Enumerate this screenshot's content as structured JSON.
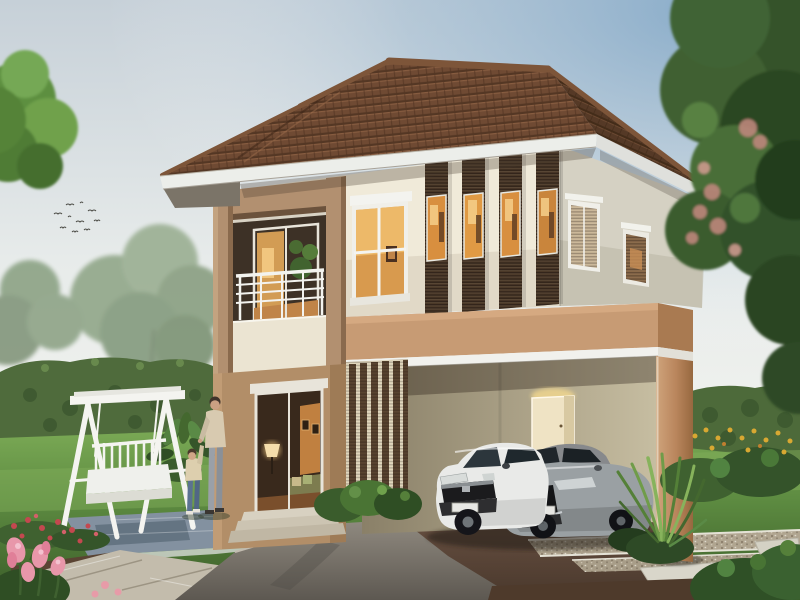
{
  "scene": {
    "type": "architectural-rendering-photo",
    "objects": [
      "two-story house with hipped tile roof",
      "balcony with white railing",
      "vertical louver window screens",
      "carport with two cars",
      "white hatchback car",
      "gray sedan car",
      "white garden swing bench",
      "adult and child walking",
      "hedges and trees",
      "lawn with stone walkway and gravel strips",
      "flower beds"
    ]
  },
  "colors": {
    "roof": "#6f4a33",
    "roof_dark": "#553926",
    "roof_ridge": "#7d5539",
    "fascia": "#eceeea",
    "wall_cream": "#f0ead9",
    "wall_side": "#d5d1c3",
    "frame_tan": "#b29070",
    "parapet": "#ebe4d2",
    "interior_dark": "#3d3126",
    "louver": "#4a3828",
    "louver_gap": "#e0d6bd",
    "carport": "#c79b74",
    "carport_side": "#a97a51",
    "trim_white": "#f1f1ed",
    "carport_wall": "#b5ab8f",
    "wall_tan": "#b28e68",
    "railing": "#f3f3ef",
    "swing": "#f4f4f0",
    "hedge": "#4f6b3c",
    "slate": "#8391a0",
    "stone": "#c3bcac",
    "car_white": "#e9eae8",
    "car_gray": "#9aa0a3",
    "window_warm": "#d88f3f",
    "flower_red": "#c4484f",
    "flower_pink": "#e897aa",
    "flower_yellow": "#d8a832"
  }
}
